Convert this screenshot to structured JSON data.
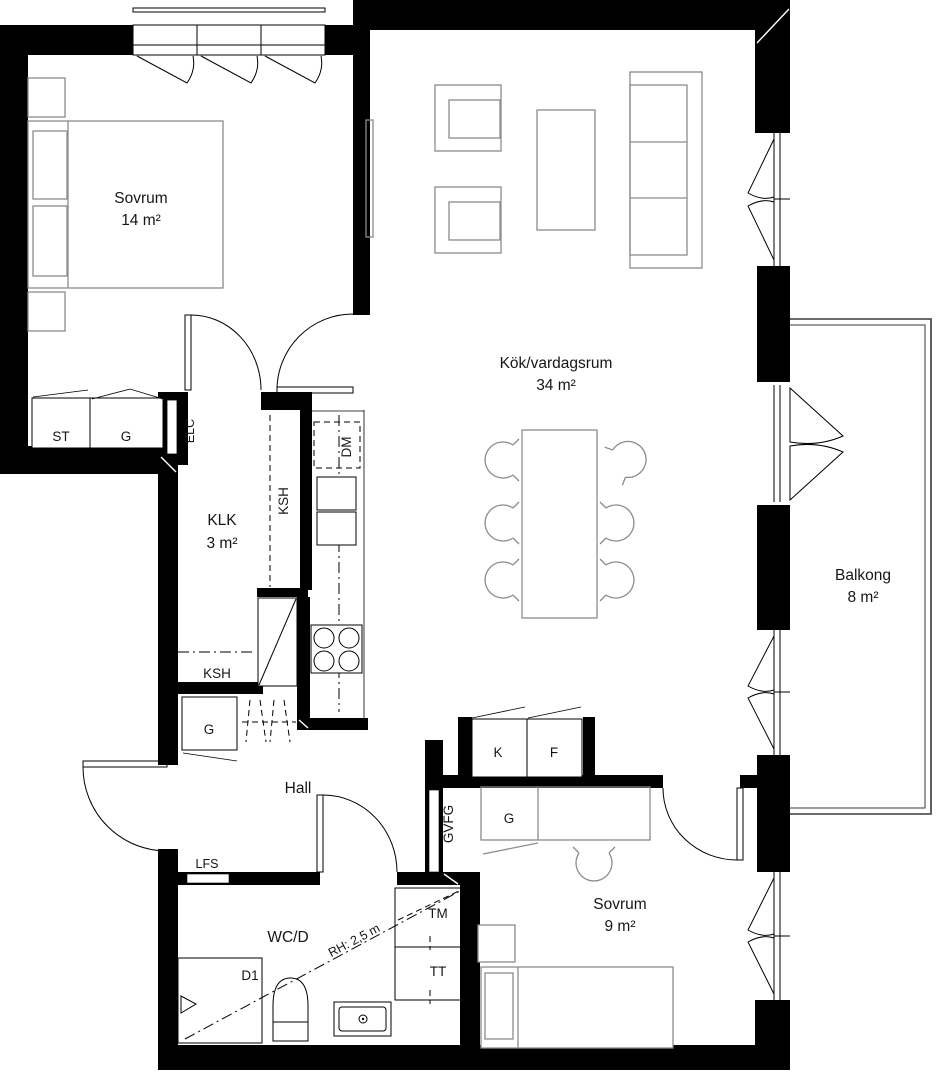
{
  "rooms": [
    {
      "name": "Sovrum",
      "area": "14 m²"
    },
    {
      "name": "Kök/vardagsrum",
      "area": "34 m²"
    },
    {
      "name": "KLK",
      "area": "3 m²"
    },
    {
      "name": "Balkong",
      "area": "8 m²"
    },
    {
      "name": "Hall"
    },
    {
      "name": "WC/D"
    },
    {
      "name": "Sovrum",
      "area": "9 m²"
    }
  ],
  "labels": {
    "st": "ST",
    "g_bedroom": "G",
    "elc": "ELC",
    "ksh_upper": "KSH",
    "dm": "DM",
    "ksh_lower": "KSH",
    "g_hall": "G",
    "k": "K",
    "f": "F",
    "g_sovrum9": "G",
    "gvfg": "GVFG",
    "lfs": "LFS",
    "tm": "TM",
    "tt": "TT",
    "d1": "D1",
    "ceiling_height": "RH: 2,5 m"
  }
}
